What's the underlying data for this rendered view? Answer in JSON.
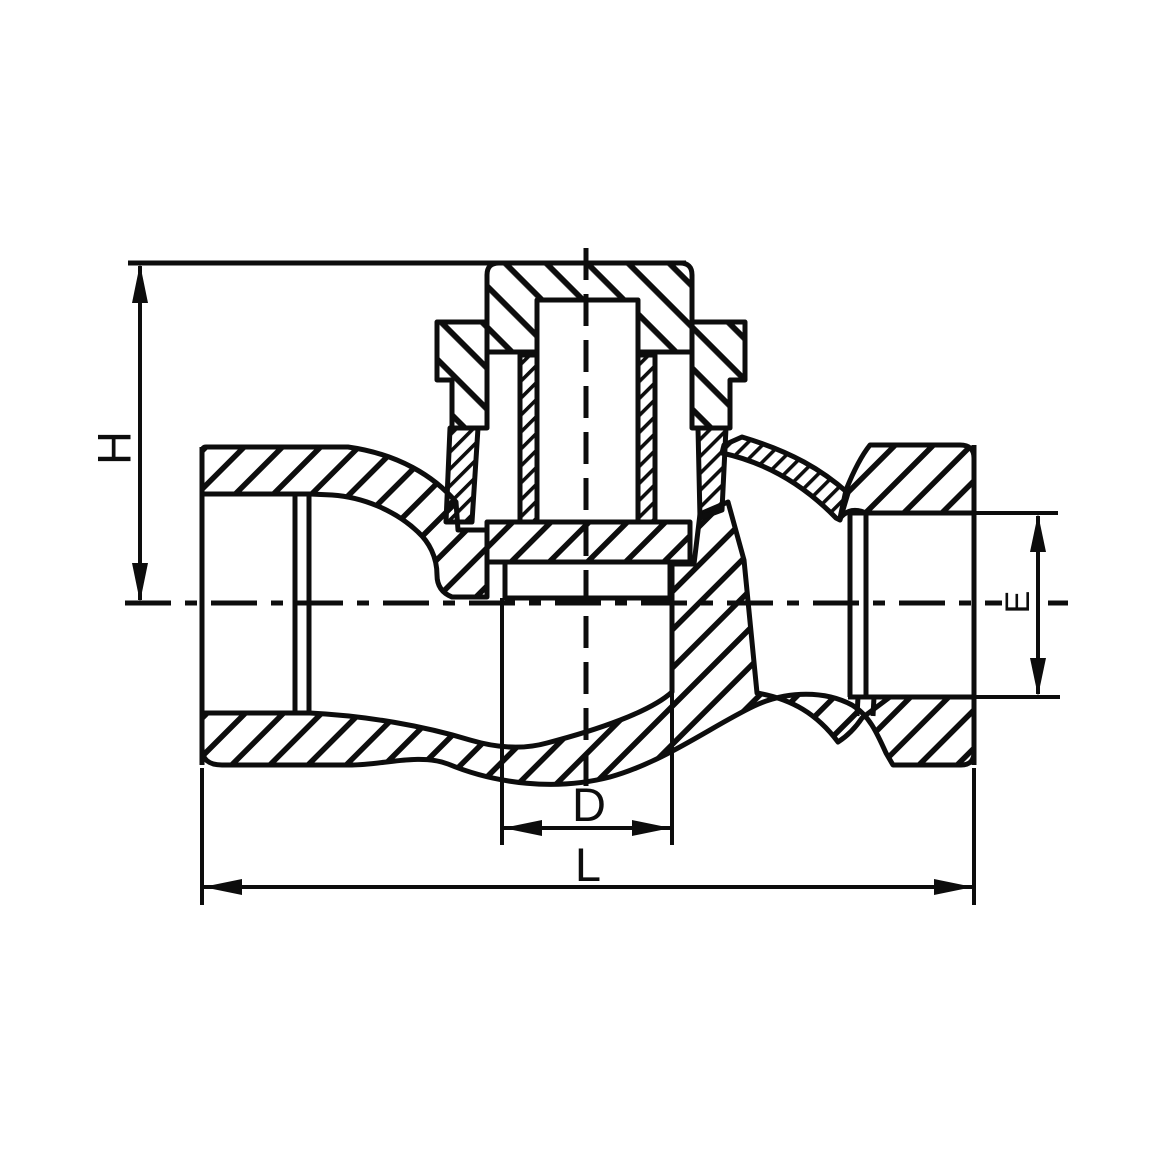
{
  "drawing": {
    "background_color": "#ffffff",
    "line_color": "#0d0d0d",
    "dimension_labels": {
      "height": "H",
      "seat_bore": "D",
      "face_to_face": "L",
      "outlet_bore": "E"
    }
  }
}
